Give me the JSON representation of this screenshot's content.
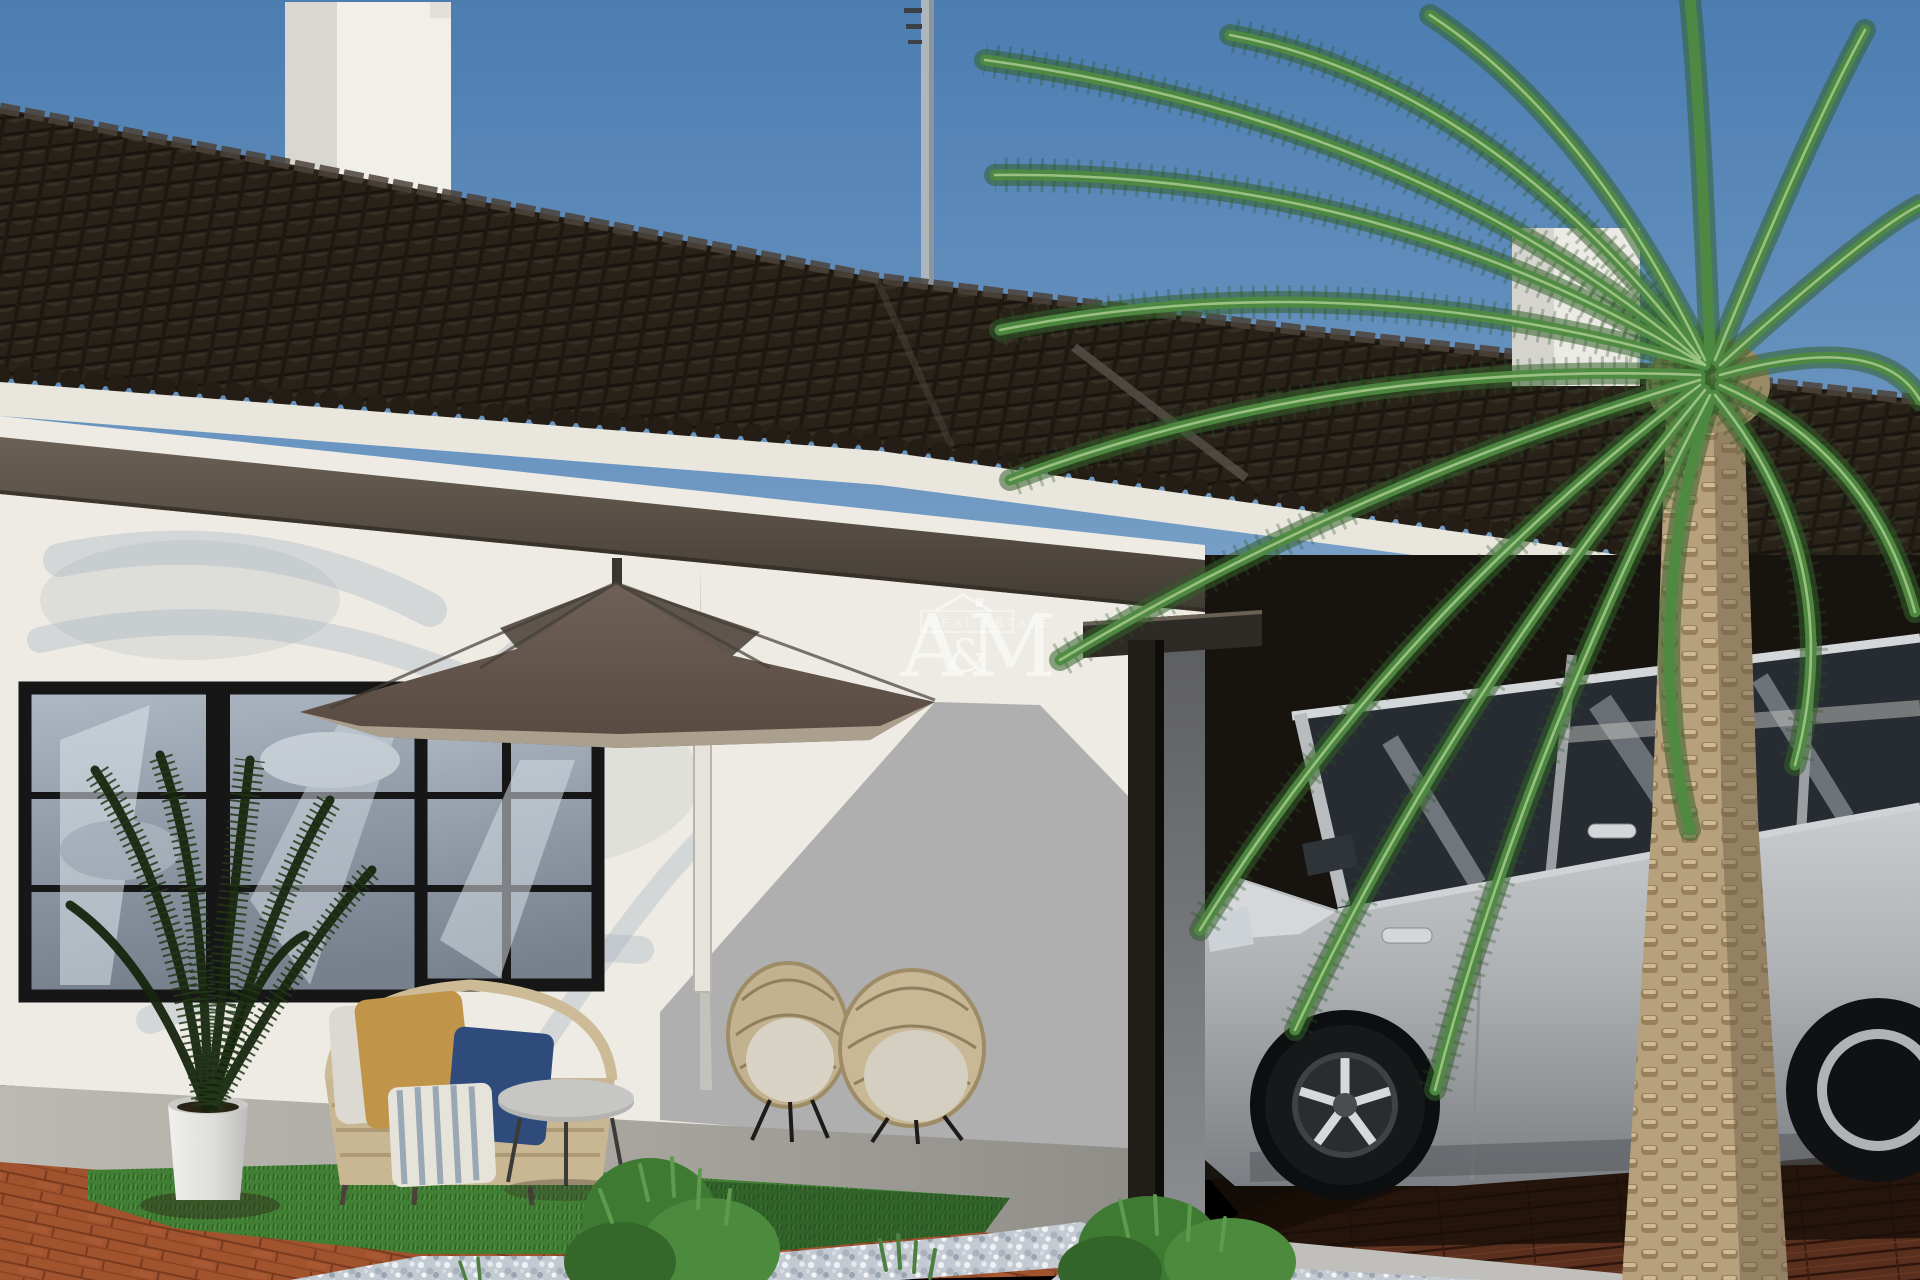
{
  "image": {
    "width": 1920,
    "height": 1280,
    "kind": "exterior 3d render of villa with carport"
  },
  "watermark": {
    "letter_a": "A",
    "ampersand": "&",
    "letter_m": "M",
    "subtitle": "REAL ESTATE",
    "icon": "house-outline-icon",
    "color": "#ffffff"
  },
  "scene": {
    "sky": "clear blue sky",
    "architecture": [
      "white single-story villa",
      "dark brown tiled gable roofs",
      "white chimney left",
      "white chimney right",
      "tv antenna",
      "black framed windows",
      "dark wood eave beam",
      "black pergola post carport"
    ],
    "furniture": [
      "taupe patio umbrella",
      "rattan loveseat",
      "mustard cushion",
      "navy cushion",
      "striped cushion",
      "round side table",
      "two rattan armchairs",
      "white planter with kentia palm"
    ],
    "vehicle": "silver suv parked under carport",
    "landscape": [
      "canary palm tree",
      "terracotta brick paving",
      "artificial grass",
      "white gravel",
      "green bushes",
      "dark wood carport decking"
    ]
  },
  "palette": {
    "sky_top": "#4c7db1",
    "sky_low": "#86abcd",
    "roof": "#292219",
    "roof_shadowline": "#191410",
    "chimney": "#efeee8",
    "fascia": "#e9e6de",
    "soffit": "#4e463d",
    "wall_light": "#edebe4",
    "wall_shadow": "#a5a5a7",
    "window_frame": "#161616",
    "glass": "#93a0ad",
    "umbrella_top": "#675f57",
    "umbrella_skirt": "#b0a492",
    "rattan": "#c9b794",
    "mustard": "#c09449",
    "navy": "#2e4b7c",
    "stripe_blue": "#9aa7b5",
    "post": "#211e19",
    "carport_dark": "#17130e",
    "car_silver": "#b9bcbe",
    "car_glass": "#262c32",
    "palm_frond": "#4e8a41",
    "palm_trunk": "#b7a17c",
    "brick": "#a1532e",
    "grass": "#417f34",
    "gravel": "#c3cad2",
    "deck": "#5a2f1e",
    "watermark": "#ffffff"
  }
}
